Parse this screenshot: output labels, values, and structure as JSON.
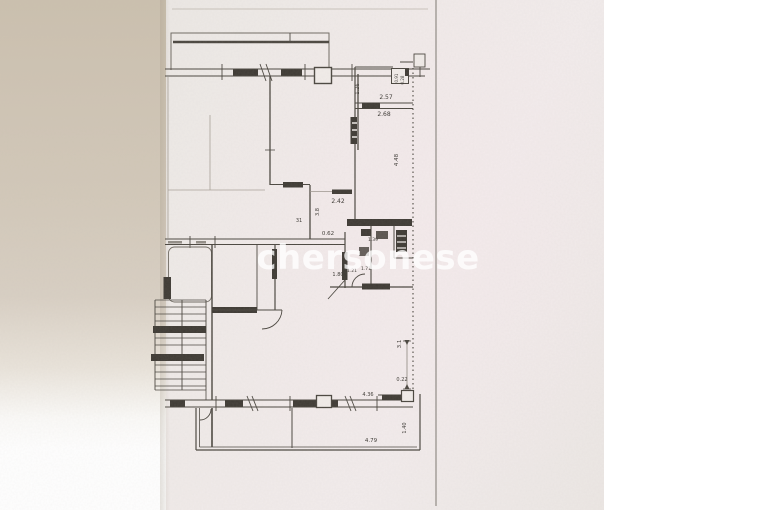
{
  "document": {
    "kind": "scanned apartment floor plan photo",
    "watermark": "chersonese"
  },
  "floor_plan": {
    "dimension_labels": [
      {
        "text": "1.26"
      },
      {
        "text": "0.91"
      },
      {
        "text": "0.28"
      },
      {
        "text": "2.57"
      },
      {
        "text": "2.68"
      },
      {
        "text": "4.48"
      },
      {
        "text": "2.42"
      },
      {
        "text": "3.8"
      },
      {
        "text": "31"
      },
      {
        "text": "0.62"
      },
      {
        "text": "1.39"
      },
      {
        "text": "1.80"
      },
      {
        "text": "1.21"
      },
      {
        "text": "1.71"
      },
      {
        "text": "3.1"
      },
      {
        "text": "0.22"
      },
      {
        "text": "4.36"
      },
      {
        "text": "4.79"
      },
      {
        "text": "1.40"
      }
    ]
  },
  "colors": {
    "ink": "#423e38",
    "ink_faint": "#a8a198",
    "paper": "#f0ebe8",
    "beige_margin": "#cfc5b4",
    "page_edge_line": "#8f8a84",
    "watermark_fill": "rgba(255,255,255,0.78)",
    "right_background": "#ffffff"
  }
}
